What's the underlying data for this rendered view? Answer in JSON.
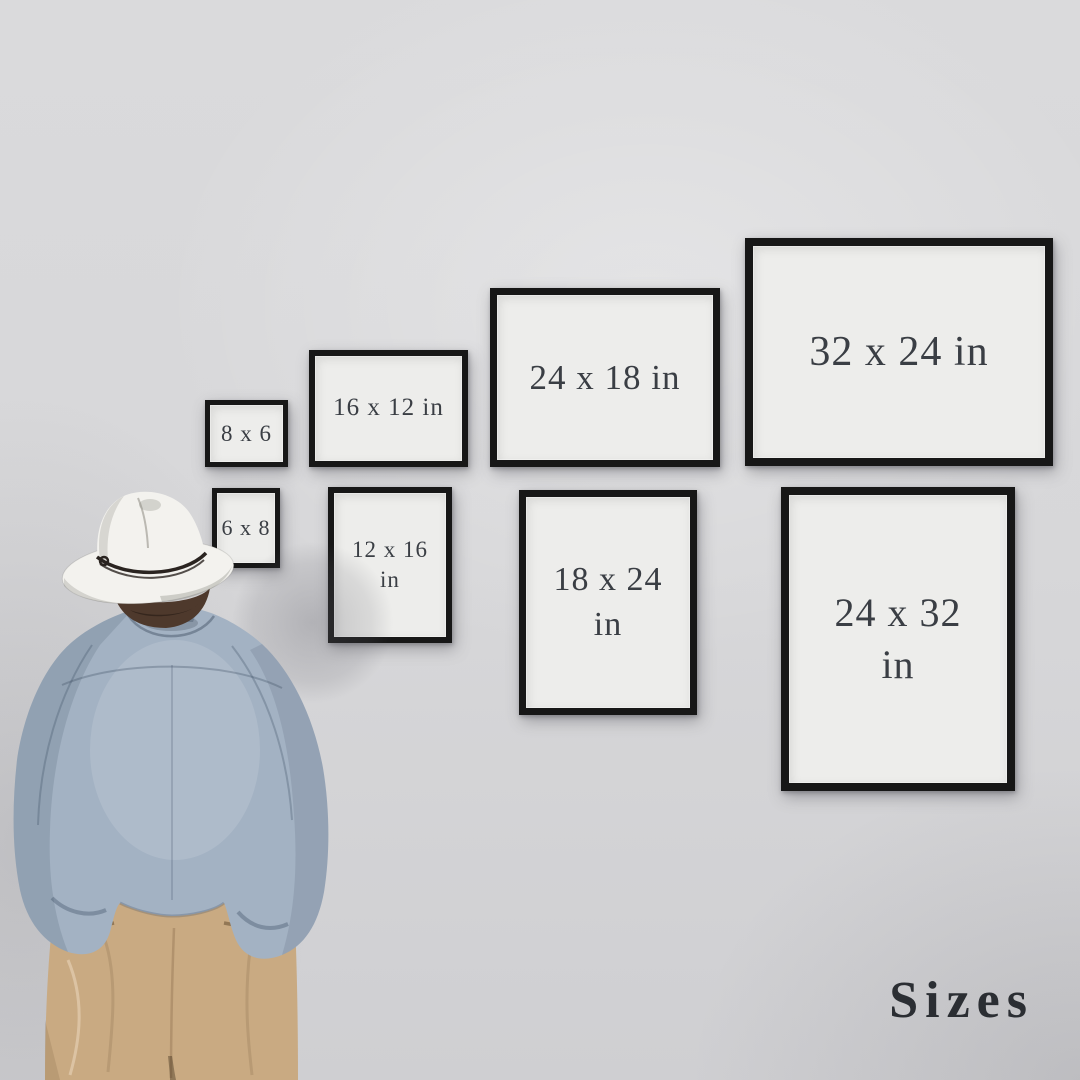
{
  "scene": {
    "caption": "Sizes",
    "colors": {
      "wall": "#d7d7d9",
      "frame-border": "#171717",
      "paper": "#ededeb",
      "label": "#3a3e44",
      "caption": "#2b2e33",
      "hat": "#f3f2ee",
      "hat-band": "#2a2420",
      "hair": "#4e392c",
      "shirt": "#a3b2c3",
      "pants": "#c9aa82"
    }
  },
  "frames": [
    {
      "size": "8 x 6",
      "lines": [
        "8 x 6"
      ]
    },
    {
      "size": "6 x 8",
      "lines": [
        "6 x 8"
      ]
    },
    {
      "size": "16 x 12 in",
      "lines": [
        "16 x 12 in"
      ]
    },
    {
      "size": "12 x 16 in",
      "lines": [
        "12 x 16",
        "in"
      ]
    },
    {
      "size": "24 x 18 in",
      "lines": [
        "24 x 18 in"
      ]
    },
    {
      "size": "18 x 24 in",
      "lines": [
        "18 x 24",
        "in"
      ]
    },
    {
      "size": "32 x 24 in",
      "lines": [
        "32 x 24 in"
      ]
    },
    {
      "size": "24 x 32 in",
      "lines": [
        "24 x 32",
        "in"
      ]
    }
  ]
}
